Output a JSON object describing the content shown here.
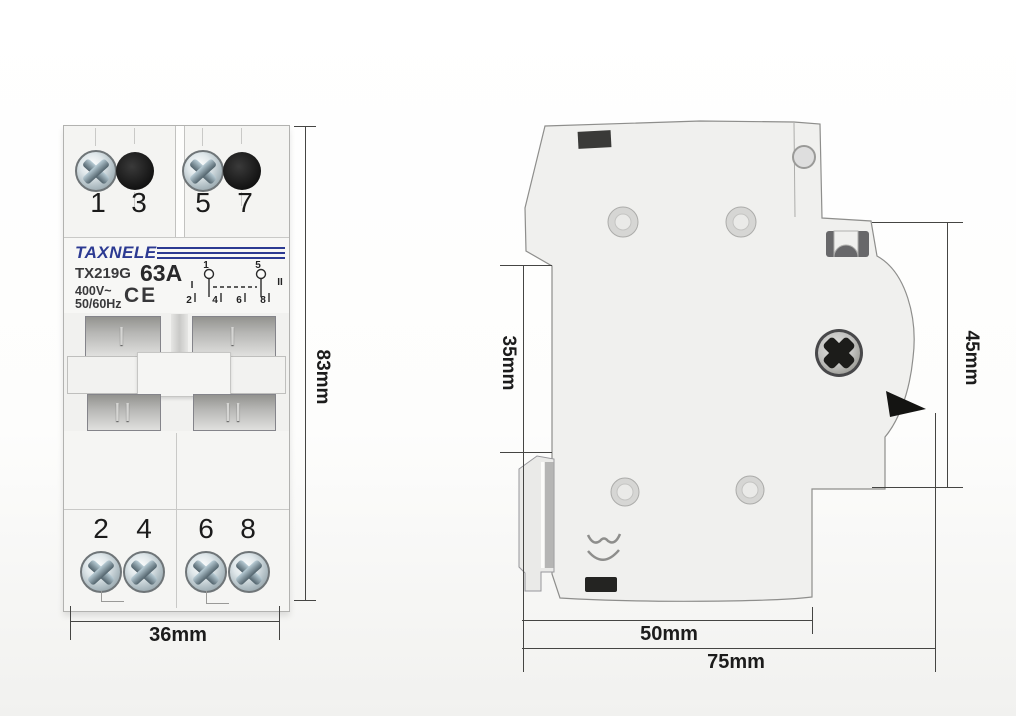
{
  "product": {
    "brand": "TAXNELE",
    "model": "TX219G",
    "current_rating": "63A",
    "voltage": "400V~",
    "frequency": "50/60Hz",
    "certification": "CE"
  },
  "front_view": {
    "top_terminals": [
      "1",
      "3",
      "5",
      "7"
    ],
    "bottom_terminals": [
      "2",
      "4",
      "6",
      "8"
    ],
    "position_marks": {
      "upper": "I",
      "lower": "II"
    },
    "wiring_diagram": {
      "top_terminals": [
        "1",
        "5"
      ],
      "position_left": "I",
      "position_right": "II",
      "bottom_terminals": [
        "2",
        "4",
        "6",
        "8"
      ]
    }
  },
  "dimensions": {
    "height": "83mm",
    "width": "36mm",
    "rail_section_height": "35mm",
    "upper_section_height": "45mm",
    "body_depth": "50mm",
    "total_depth": "75mm"
  },
  "colors": {
    "brand_blue": "#2c3a92",
    "body_light": "#f3f3f1",
    "dimension_line": "#454543"
  }
}
